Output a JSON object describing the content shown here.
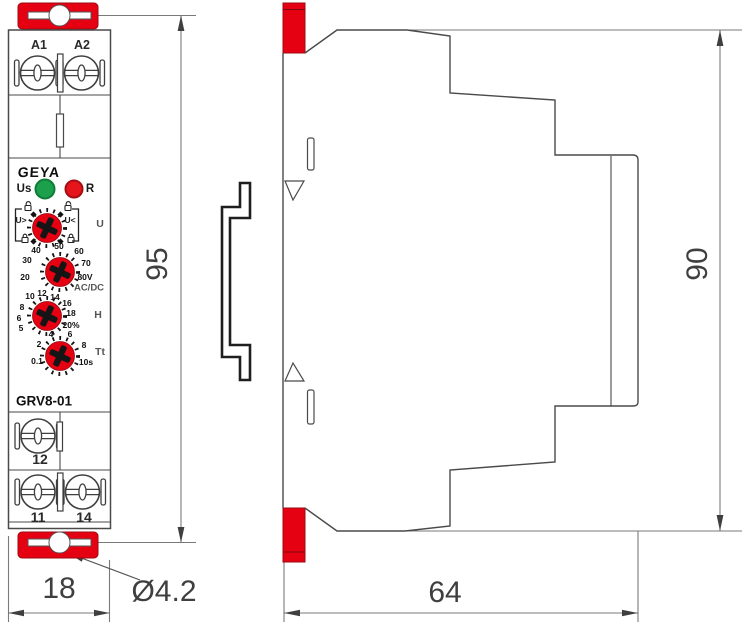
{
  "front_view": {
    "terminal_labels_top": [
      "A1",
      "A2"
    ],
    "logo": "GEYA",
    "led_us_label": "Us",
    "led_r_label": "R",
    "knob_u": {
      "left_label": "U>",
      "right_label": "U<",
      "side_label": "U"
    },
    "knob_voltage": {
      "scale": [
        "20",
        "30",
        "40",
        "50",
        "60",
        "70",
        "80V"
      ],
      "side_label": "AC/DC"
    },
    "knob_hysteresis": {
      "scale": [
        "5",
        "6",
        "8",
        "10",
        "12",
        "14",
        "16",
        "18",
        "20%"
      ],
      "side_label": "H"
    },
    "knob_time": {
      "scale": [
        "0.1",
        "2",
        "4",
        "6",
        "8",
        "10s"
      ],
      "side_label": "Tt"
    },
    "model": "GRV8-01",
    "terminal_label_mid": "12",
    "terminal_labels_bottom": [
      "11",
      "14"
    ]
  },
  "dimensions": {
    "front_height": "95",
    "front_width": "18",
    "mount_hole": "Ø4.2",
    "side_height": "90",
    "side_depth": "64"
  },
  "colors": {
    "accent_red": "#e50012",
    "led_green": "#1ca04c",
    "led_red": "#e6151b",
    "outline": "#4a4a4a",
    "dim_line": "#7a7a7a"
  }
}
